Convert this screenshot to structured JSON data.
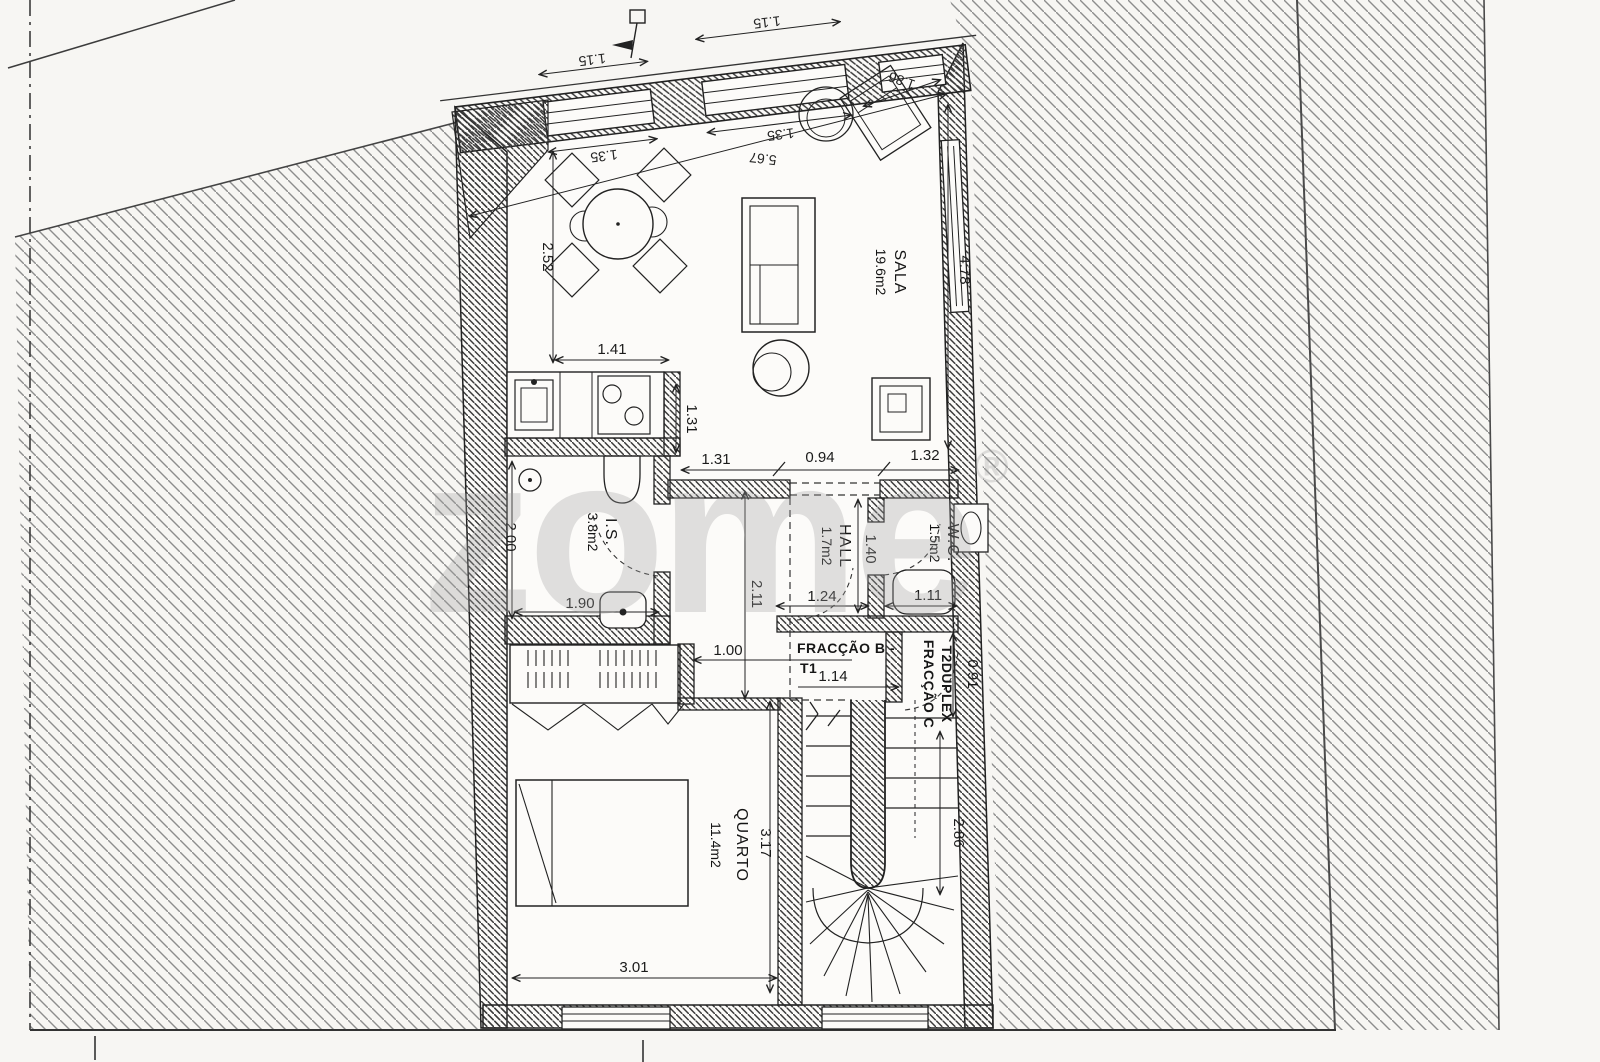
{
  "watermark": {
    "text": "zome",
    "reg": "®"
  },
  "rooms": {
    "sala": {
      "name": "SALA",
      "area": "19.6m2"
    },
    "is": {
      "name": "I.S.",
      "area": "3.8m2"
    },
    "hall": {
      "name": "HALL",
      "area": "1.7m2"
    },
    "wc": {
      "name": "W.C.",
      "area": "1.5m2"
    },
    "quarto": {
      "name": "QUARTO",
      "area": "11.4m2"
    }
  },
  "units": {
    "b": {
      "line1": "FRACÇÃO B -",
      "line2": "T1"
    },
    "c": {
      "line1": "FRACÇÃO C",
      "line2": "T2DUPLEX"
    }
  },
  "dimensions": {
    "top": {
      "d115a": "1.15",
      "d115b": "1.15",
      "d135a": "1.35",
      "d135b": "1.35",
      "d567": "5.67",
      "d186": "1.86"
    },
    "sala": {
      "d252": "2.52",
      "d141": "1.41",
      "d131v": "1.31",
      "d478": "4.78"
    },
    "corridor": {
      "d131": "1.31",
      "d094": "0.94",
      "d132": "1.32"
    },
    "is": {
      "d200": "2.00",
      "d190": "1.90"
    },
    "hall": {
      "d211": "2.11",
      "d140": "1.40",
      "d124": "1.24",
      "d111": "1.11"
    },
    "units": {
      "d100": "1.00",
      "d114": "1.14",
      "d091": "0.91"
    },
    "quarto": {
      "d317": "3.17",
      "d301": "3.01"
    },
    "stair": {
      "d286": "2.86"
    }
  },
  "colors": {
    "paper": "#f7f6f3",
    "line": "#2a2a2a",
    "siteHatch": "#8d8d8d",
    "wallHatch": "#3a3a3a",
    "watermark": "#9f9f9f"
  }
}
